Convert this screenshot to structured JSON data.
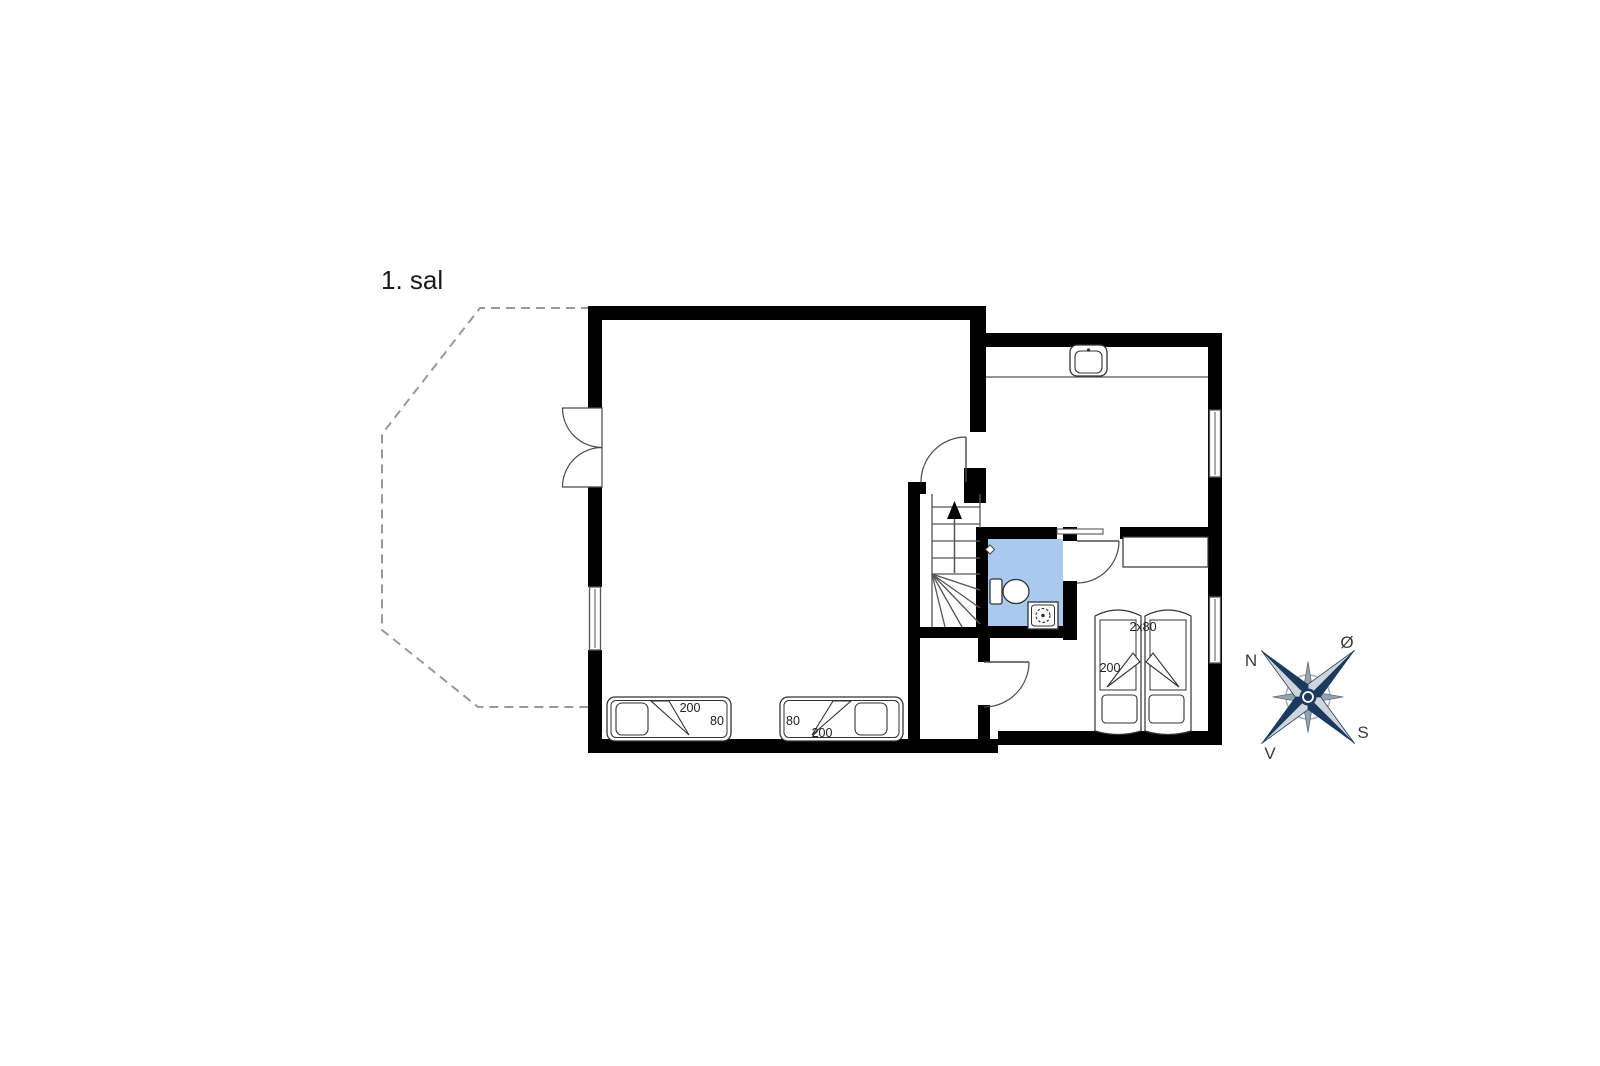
{
  "floor_label": "1. sal",
  "plan": {
    "beds": {
      "single_left": {
        "length": "200",
        "width": "80"
      },
      "single_right": {
        "length": "200",
        "width": "80"
      },
      "double": {
        "size": "2x80",
        "length": "200"
      }
    },
    "compass": {
      "north": "N",
      "east": "Ø",
      "south": "S",
      "west": "V"
    }
  },
  "colors": {
    "wall": "#000000",
    "bathroom_floor": "#a9c9ee",
    "line": "#444444",
    "dashed_outline": "#999999",
    "compass_primary": "#1c3a5e",
    "compass_secondary": "#cfd5da"
  }
}
